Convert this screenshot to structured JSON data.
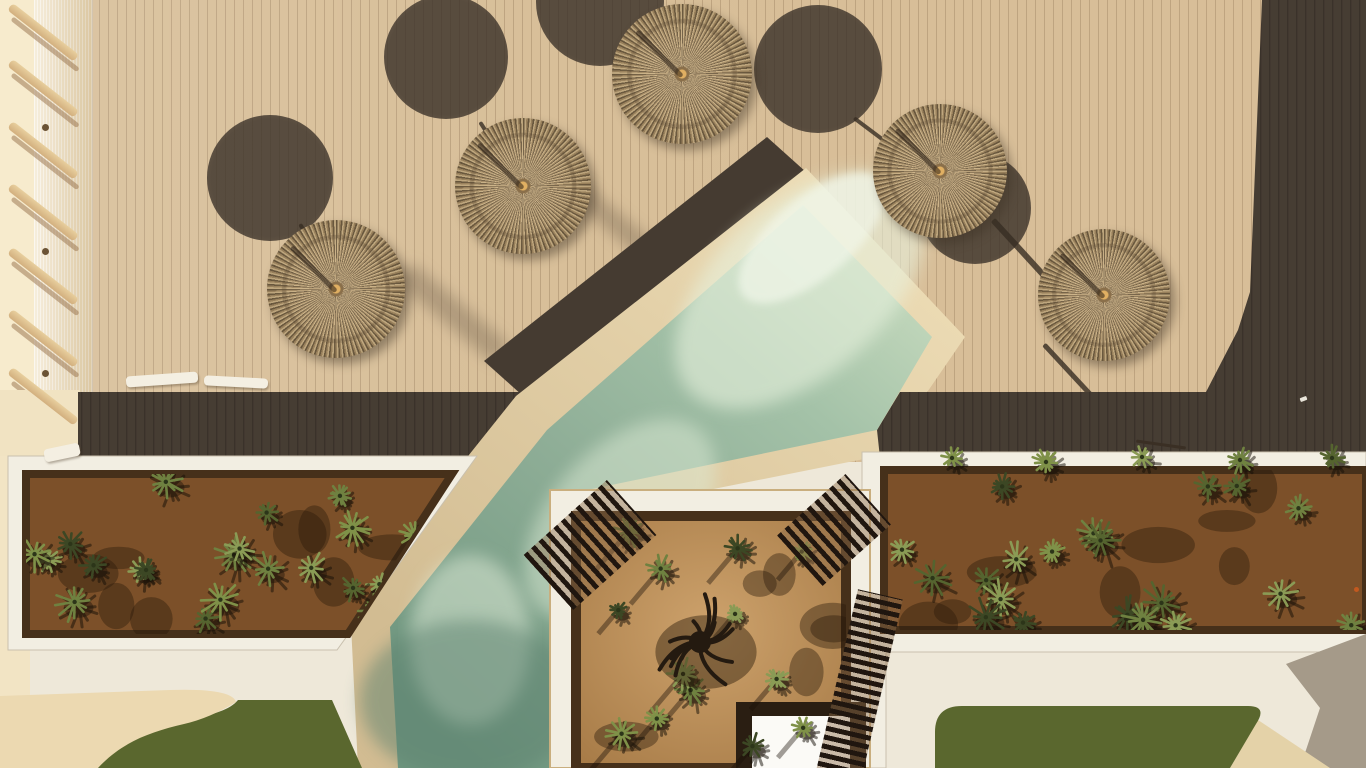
{
  "meta": {
    "description": "Aerial drone photo of a hotel pool deck with straw umbrellas, diagonal pool, succulent planters and lawn",
    "width": 1366,
    "height": 768
  },
  "palette": {
    "deck": "#d8bf99",
    "deck_dark": "#463d33",
    "pale_strip": "#f7ebcd",
    "coping": "#e2cda2",
    "water_mid": "#8fae97",
    "white_walk": "#eee8d9",
    "soil": "#7c5029",
    "soil_dark": "#46301a",
    "court_sand": "#bb8f58",
    "grass": "#5a672e",
    "sand": "#ecd9b1",
    "gray_shadow": "#a59a89",
    "slat": "#20160f",
    "pad_border": "#2a1e12",
    "pad": "#fbfaf6",
    "straw": "#a98f66",
    "stick": "#3a2f24",
    "orange_item": "#c2591f",
    "white_dot": "#e9e5da"
  },
  "geometry": {
    "top_right_dark_points": "1262,0 1366,0 1366,392 1206,392 1238,330 1250,292",
    "band_left_points": "78,392 521,392 470,456 78,456",
    "band_right_points": "900,392 1366,392 1366,458 880,458 877,430",
    "diag_band_points": "767,137 806,172 523,396 484,361",
    "coping_points": "806,168 965,337 884,455 598,512 560,519 560,768 358,768 350,604 516,396",
    "water_points": "803,205 932,337 877,430 592,489 553,498 553,768 398,768 390,627 547,430",
    "left_planter_frame_points": "8,456 477,456 337,650 8,650",
    "left_planter_soil_points": "26,474 452,474 348,634 26,634",
    "right_planter_frame_d": "M862,452 L1366,452 L1366,652 L886,652 L886,768 L862,768 Z",
    "right_planter_soil_d": "M884,470 L1366,470 L1366,630 L884,630 Z",
    "court_frame_d": "M550,490 L870,490 L870,768 L550,768 Z",
    "court_soil_d": "M576,516 L846,516 L846,768 L576,768 Z",
    "pad_border_points": "736,702 866,702 866,768 736,768",
    "pad_points": "752,716 850,716 850,768 752,768",
    "grass_left_d": "M96,768 C120,740 152,728 188,720 C214,714 230,710 238,700 L332,700 L362,768 Z",
    "grass_right_d": "M935,768 L935,732 Q935,706 962,706 L1248,706 Q1268,706 1256,724 L1230,768 Z",
    "sand_left_d": "M0,768 L0,696 L170,690 Q232,688 236,702 Q210,718 184,724 C150,732 122,742 98,768 Z",
    "sand_wedge_d": "M1230,768 L1258,720 L1330,768 Z",
    "gray_shadow_d": "M1366,634 L1286,664 L1320,708 L1300,768 L1366,768 Z",
    "left_edge_pale_x": 0,
    "left_edge_pale_y": 390,
    "left_edge_pale_w": 80,
    "left_edge_pale_h": 76
  },
  "umbrellas": [
    {
      "x": 336,
      "y": 289,
      "r": 69
    },
    {
      "x": 523,
      "y": 186,
      "r": 68
    },
    {
      "x": 682,
      "y": 74,
      "r": 70
    },
    {
      "x": 940,
      "y": 171,
      "r": 67
    },
    {
      "x": 1104,
      "y": 295,
      "r": 66
    }
  ],
  "canopy_shadows": [
    {
      "x": 270,
      "y": 178,
      "r": 63
    },
    {
      "x": 446,
      "y": 57,
      "r": 62
    },
    {
      "x": 600,
      "y": 2,
      "r": 64
    },
    {
      "x": 818,
      "y": 69,
      "r": 64
    },
    {
      "x": 975,
      "y": 208,
      "r": 56
    }
  ],
  "pole_shadow_lines": [
    {
      "x1": 300,
      "y1": 222,
      "x2": 316,
      "y2": 250,
      "w": 4
    },
    {
      "x1": 480,
      "y1": 120,
      "x2": 498,
      "y2": 148,
      "w": 4
    },
    {
      "x1": 854,
      "y1": 116,
      "x2": 890,
      "y2": 143,
      "w": 4
    },
    {
      "x1": 993,
      "y1": 217,
      "x2": 1048,
      "y2": 277,
      "w": 6
    },
    {
      "x1": 1044,
      "y1": 342,
      "x2": 1096,
      "y2": 398,
      "w": 5
    }
  ],
  "soft_streaks": [
    {
      "x": 388,
      "y": 300,
      "len": 130,
      "w": 26,
      "rot": 40
    },
    {
      "x": 560,
      "y": 212,
      "len": 110,
      "w": 22,
      "rot": 40
    }
  ],
  "railing": {
    "bar_x": 10,
    "bar_w": 84,
    "bar_h": 9,
    "bar_rot": 38,
    "bar_ys": [
      2,
      58,
      120,
      182,
      246,
      308,
      366
    ],
    "posts": [
      {
        "x": 42,
        "y": 124
      },
      {
        "x": 42,
        "y": 248
      },
      {
        "x": 42,
        "y": 370
      }
    ]
  },
  "loungers": [
    {
      "x": 126,
      "y": 374,
      "w": 72,
      "h": 11,
      "rot": -4
    },
    {
      "x": 204,
      "y": 377,
      "w": 64,
      "h": 10,
      "rot": 3
    },
    {
      "x": 44,
      "y": 446,
      "w": 36,
      "h": 13,
      "rot": -12
    }
  ],
  "slat_benches": [
    {
      "x": 534,
      "y": 508,
      "w": 112,
      "h": 74,
      "rot": -42,
      "pitch": 10,
      "thick": 5,
      "angle": 90
    },
    {
      "x": 788,
      "y": 496,
      "w": 92,
      "h": 68,
      "rot": -42,
      "pitch": 10,
      "thick": 5,
      "angle": 90
    },
    {
      "x": 836,
      "y": 592,
      "w": 46,
      "h": 190,
      "rot": 13,
      "pitch": 9,
      "thick": 5,
      "angle": 0
    }
  ],
  "small_items": [
    {
      "x": 1136,
      "y": 443,
      "w": 50,
      "h": 3,
      "rot": 8,
      "color": "#3a2f24",
      "round": false
    },
    {
      "x": 1300,
      "y": 397,
      "w": 7,
      "h": 4,
      "rot": -20,
      "color": "#e9e5da",
      "round": false
    },
    {
      "x": 1354,
      "y": 587,
      "w": 5,
      "h": 5,
      "rot": 0,
      "color": "#c2591f",
      "round": true
    }
  ],
  "plants": {
    "seed": 9,
    "areas": [
      {
        "clip": "clipL",
        "count": 24,
        "x0": 34,
        "x1": 448,
        "y0": 480,
        "y1": 628,
        "rmin": 10,
        "rmax": 20,
        "streak": false,
        "blobs": 8
      },
      {
        "clip": "clipR",
        "count": 20,
        "x0": 892,
        "x1": 1358,
        "y0": 476,
        "y1": 626,
        "rmin": 11,
        "rmax": 21,
        "streak": false,
        "blobs": 8
      },
      {
        "clip": "clipC",
        "count": 13,
        "x0": 584,
        "x1": 838,
        "y0": 524,
        "y1": 756,
        "rmin": 9,
        "rmax": 17,
        "streak": true,
        "blobs": 6
      }
    ],
    "overhang": [
      {
        "x": 952,
        "y": 458,
        "r": 12
      },
      {
        "x": 1046,
        "y": 462,
        "r": 13
      },
      {
        "x": 1142,
        "y": 457,
        "r": 12
      },
      {
        "x": 1240,
        "y": 460,
        "r": 13
      },
      {
        "x": 1332,
        "y": 458,
        "r": 12
      }
    ],
    "colors": [
      "#6f8140",
      "#55642f",
      "#8a9b55",
      "#3c4724",
      "#7f9148"
    ],
    "tree": {
      "x": 700,
      "y": 642,
      "r": 46
    }
  }
}
